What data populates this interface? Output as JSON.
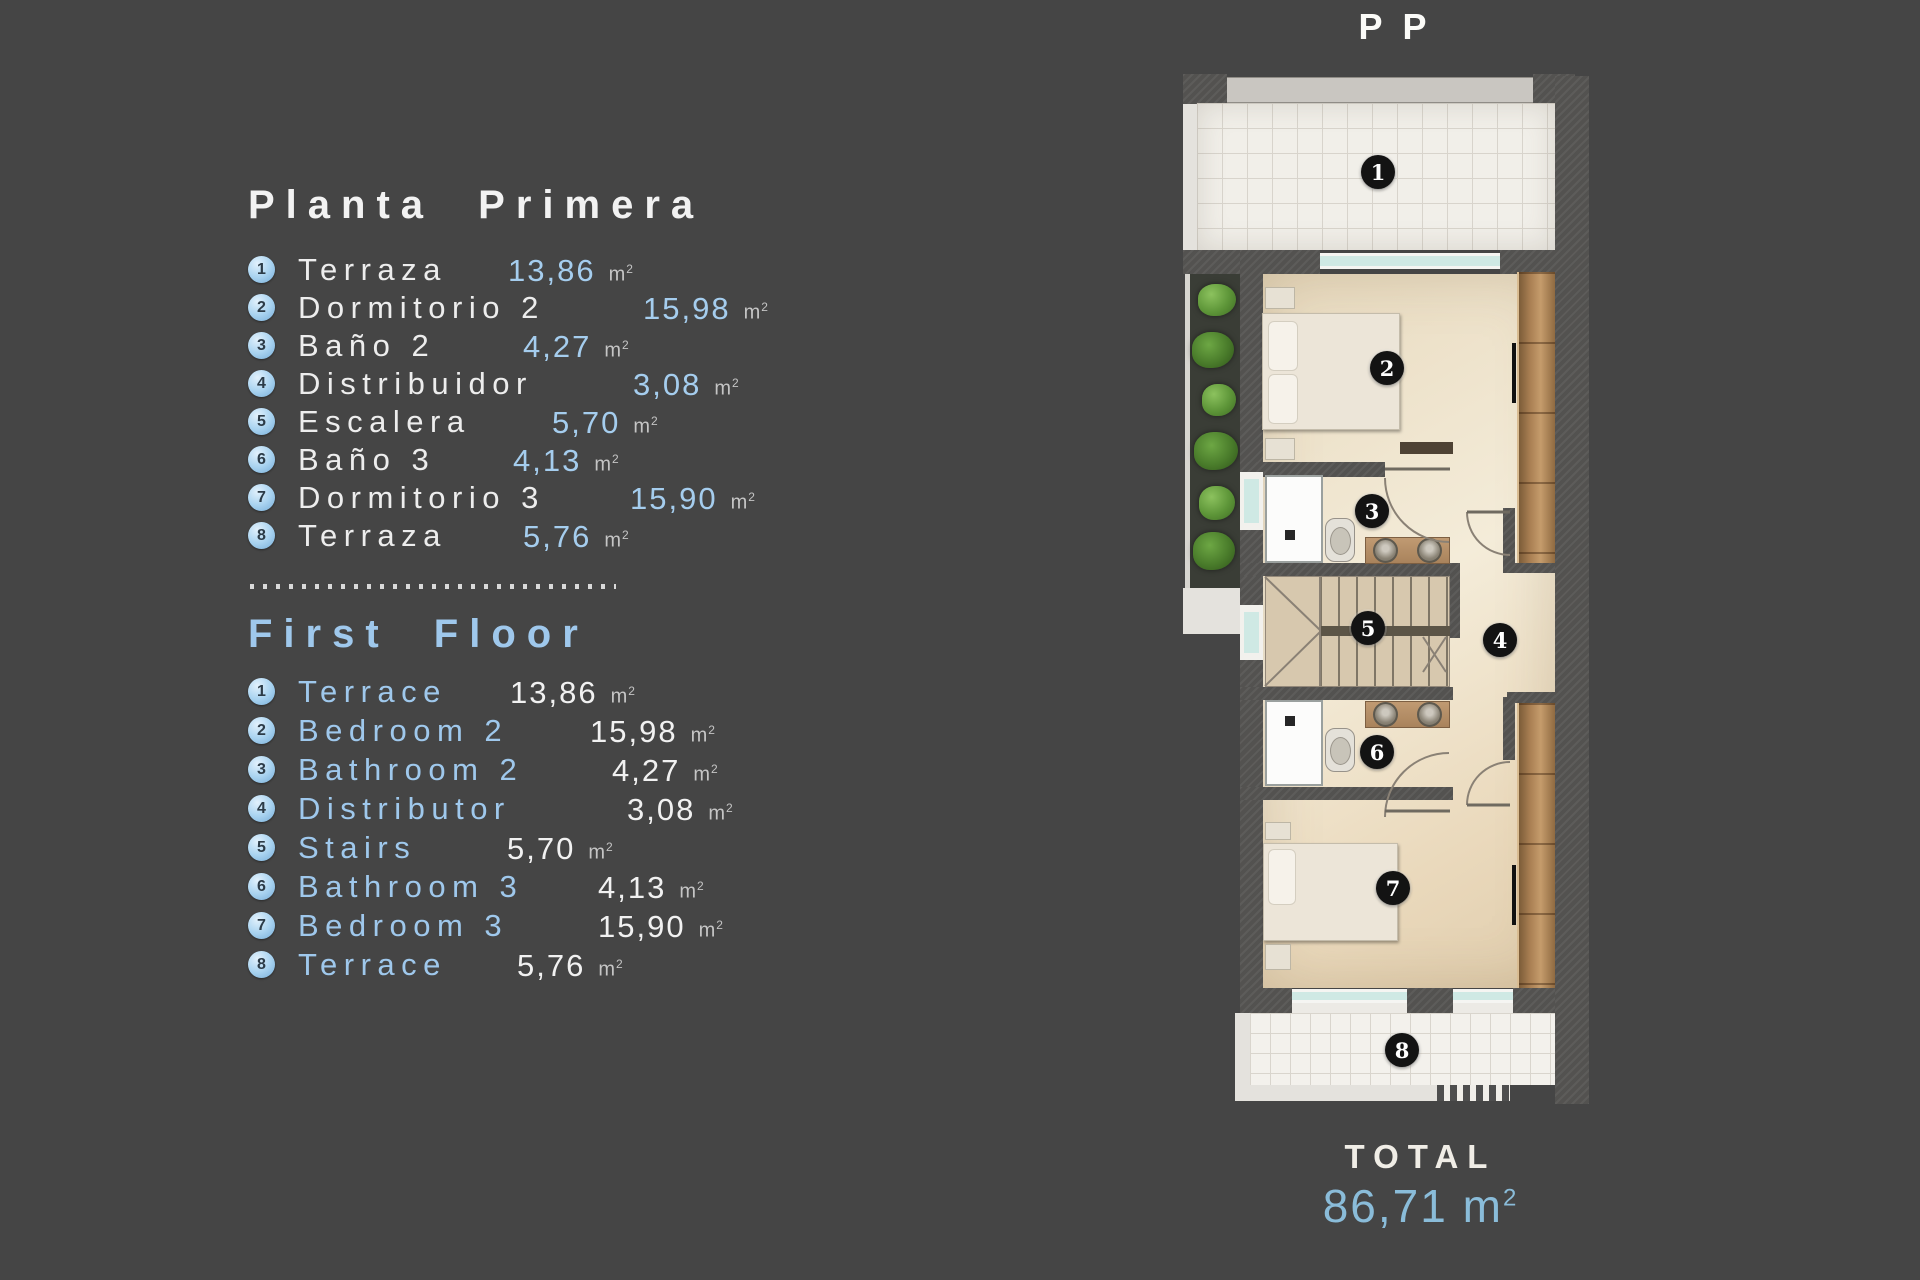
{
  "colors": {
    "background": "#454545",
    "accent_blue": "#a2cbe9",
    "total_blue": "#8abcd9",
    "text_white": "#f2f2f2",
    "unit_gray": "#c5c5c5"
  },
  "header": {
    "plan_code": "PP"
  },
  "unit": {
    "base": "m",
    "sup": "2"
  },
  "legend_es": {
    "title": "Planta Primera",
    "items": [
      {
        "num": "1",
        "name": "Terraza",
        "value": "13,86"
      },
      {
        "num": "2",
        "name": "Dormitorio 2",
        "value": "15,98"
      },
      {
        "num": "3",
        "name": "Baño 2",
        "value": "4,27"
      },
      {
        "num": "4",
        "name": "Distribuidor",
        "value": "3,08"
      },
      {
        "num": "5",
        "name": "Escalera",
        "value": "5,70"
      },
      {
        "num": "6",
        "name": "Baño 3",
        "value": "4,13"
      },
      {
        "num": "7",
        "name": "Dormitorio 3",
        "value": "15,90"
      },
      {
        "num": "8",
        "name": "Terraza",
        "value": "5,76"
      }
    ]
  },
  "legend_en": {
    "title": "First Floor",
    "items": [
      {
        "num": "1",
        "name": "Terrace",
        "value": "13,86"
      },
      {
        "num": "2",
        "name": "Bedroom 2",
        "value": "15,98"
      },
      {
        "num": "3",
        "name": "Bathroom 2",
        "value": "4,27"
      },
      {
        "num": "4",
        "name": "Distributor",
        "value": "3,08"
      },
      {
        "num": "5",
        "name": "Stairs",
        "value": "5,70"
      },
      {
        "num": "6",
        "name": "Bathroom 3",
        "value": "4,13"
      },
      {
        "num": "7",
        "name": "Bedroom 3",
        "value": "15,90"
      },
      {
        "num": "8",
        "name": "Terrace",
        "value": "5,76"
      }
    ]
  },
  "total": {
    "label": "TOTAL",
    "value": "86,71"
  },
  "floorplan": {
    "rooms": [
      {
        "num": "1"
      },
      {
        "num": "2"
      },
      {
        "num": "3"
      },
      {
        "num": "4"
      },
      {
        "num": "5"
      },
      {
        "num": "6"
      },
      {
        "num": "7"
      },
      {
        "num": "8"
      }
    ]
  }
}
